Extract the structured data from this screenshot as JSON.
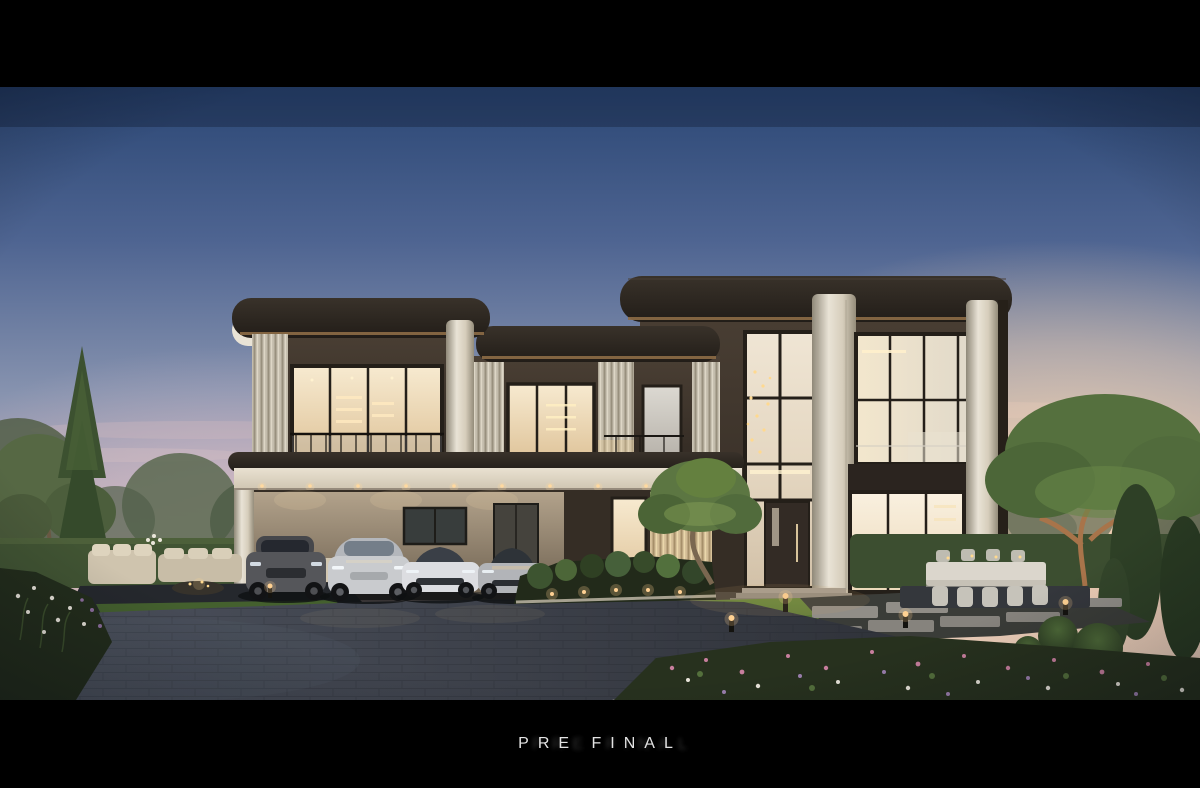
{
  "meta": {
    "type": "architectural-rendering",
    "scene": "modern luxury two-story residence at dusk"
  },
  "caption": {
    "text": "PRE FINAL",
    "color": "#e3e3e3"
  },
  "palette": {
    "sky_top": "#2b4775",
    "sky_mid": "#8793af",
    "sky_lavender": "#b4a9b7",
    "sky_horizon": "#eed7c6",
    "sunset_peach": "#f6d2ae",
    "facade_dark": "#4a3f34",
    "roof_dark": "#39322a",
    "trim_bronze": "#8d6c46",
    "stone_cream": "#e9e3d6",
    "glass_warm": "#f7ead0",
    "interior_light": "#ffd193",
    "lawn_green": "#69873c",
    "hedge_green": "#415433",
    "foliage_green": "#49613a",
    "paving_grey": "#4d525e",
    "water_dark": "#161b21",
    "flower_pink": "#c87f9e",
    "flower_white": "#e8e4da"
  },
  "scene": {
    "sky": {
      "top": "#2b4775",
      "mid": "#8793af",
      "horizon": "#eed7c6",
      "glow": "#f6d2ae"
    },
    "house": {
      "facade": "#4a3f34",
      "roof": "#39322a",
      "stone": "#e9e3d6",
      "bronze": "#8d6c46"
    },
    "landscape": {
      "lawn": "#69873c",
      "hedge": "#415433",
      "paving": "#4d525e",
      "water": "#161b21"
    },
    "vehicles": [
      {
        "type": "luxury SUV",
        "color": "dark grey",
        "hex": "#55565a"
      },
      {
        "type": "electric SUV",
        "color": "silver",
        "hex": "#c9cbce"
      },
      {
        "type": "supercar",
        "color": "white",
        "hex": "#dcdde1"
      },
      {
        "type": "supercar",
        "color": "silver",
        "hex": "#b2b4b8"
      }
    ],
    "lighting": {
      "downlight": "#ffd9a0",
      "path_light": "#ffd193"
    }
  }
}
